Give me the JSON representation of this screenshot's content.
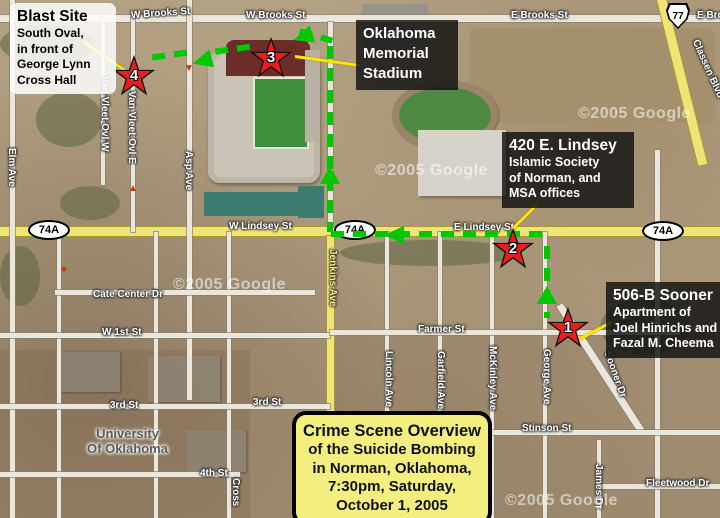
{
  "callouts": {
    "blast": {
      "title": "Blast Site",
      "l1": "South Oval,",
      "l2": "in front of",
      "l3": "George Lynn",
      "l4": "Cross Hall"
    },
    "stadium": {
      "l1": "Oklahoma",
      "l2": "Memorial",
      "l3": "Stadium"
    },
    "lindsey420": {
      "title": "420 E. Lindsey",
      "l1": "Islamic Society",
      "l2": "of Norman, and",
      "l3": "MSA offices"
    },
    "sooner506": {
      "title": "506-B Sooner",
      "l1": "Apartment of",
      "l2": "Joel Hinrichs and",
      "l3": "Fazal M. Cheema"
    }
  },
  "title_box": {
    "l1": "Crime Scene Overview",
    "l2": "of the Suicide Bombing",
    "l3": "in Norman, Oklahoma,",
    "l4": "7:30pm, Saturday,",
    "l5": "October 1, 2005"
  },
  "markers": {
    "m1": "1",
    "m2": "2",
    "m3": "3",
    "m4": "4"
  },
  "shields": {
    "route74a": "74A",
    "us77": "77"
  },
  "streets": {
    "w_brooks_1": "W Brooks St",
    "w_brooks_2": "W Brooks St",
    "e_brooks_1": "E Brooks St",
    "e_brooks_2": "E Brooks St",
    "w_lindsey": "W Lindsey St",
    "e_lindsey": "E Lindsey St",
    "cate_center": "Cate Center Dr",
    "w_1st": "W 1st St",
    "third_1": "3rd St",
    "third_2": "3rd St",
    "fourth": "4th St",
    "farmer": "Farmer St",
    "stinson": "Stinson St",
    "fleetwood": "Fleetwood Dr",
    "elm": "Elm Ave",
    "van_vleet_w": "Van Vleet Ovl W",
    "van_vleet_e": "Van Vleet Ovl E",
    "asp": "Asp Ave",
    "jenkins": "Jenkins Ave",
    "lincoln": "Lincoln Ave",
    "garfield": "Garfield Ave",
    "mckinley": "McKinley Ave",
    "george": "George Ave",
    "sooner": "Sooner Dr",
    "james": "James Dr",
    "classen": "Classen Blvd",
    "cross": "Cross"
  },
  "campus": {
    "l1": "University",
    "l2": "Of Oklahoma"
  },
  "watermark": "©2005 Google",
  "icons": {
    "arrow_down": "▼",
    "arrow_up": "▲"
  },
  "colors": {
    "route_green": "#00c800",
    "star_red": "#ea1c1c",
    "highway_yellow": "#f0e476",
    "pointer_yellow": "#ffe603",
    "title_bg": "#f3ee7d"
  }
}
